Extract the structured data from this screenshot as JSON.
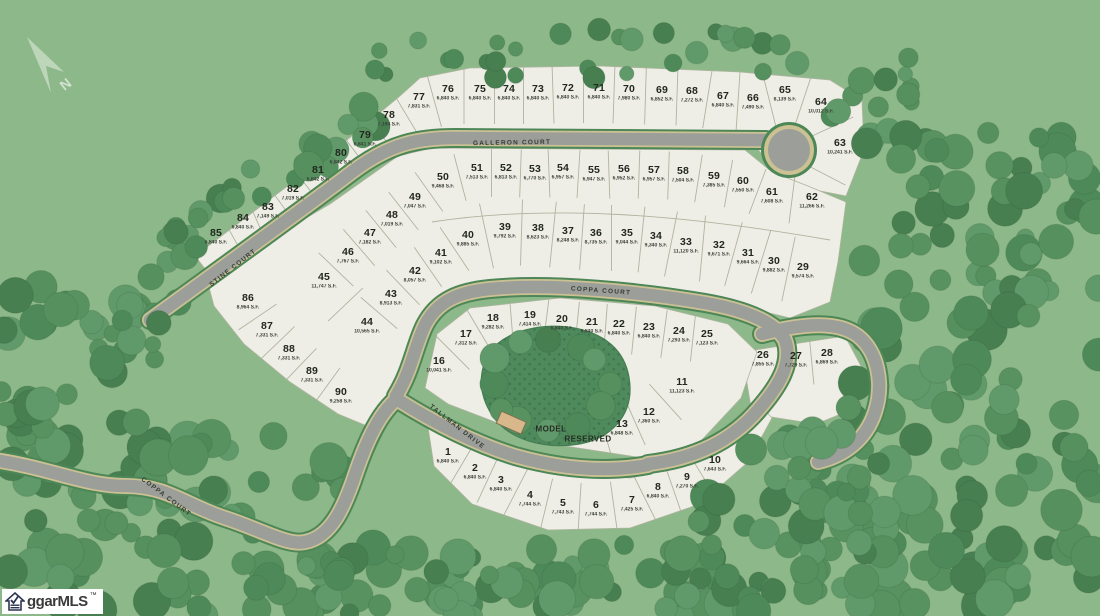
{
  "map": {
    "north_label": "N",
    "logo": {
      "text": "ggarMLS",
      "tm": "™"
    },
    "streets": [
      {
        "name": "GALLERON COURT",
        "x": 512,
        "y": 143,
        "rot": -1
      },
      {
        "name": "COPPA COURT",
        "x": 601,
        "y": 291,
        "rot": 4
      },
      {
        "name": "STINE COURT",
        "x": 233,
        "y": 268,
        "rot": -38
      },
      {
        "name": "TALLMAN DRIVE",
        "x": 457,
        "y": 427,
        "rot": 38
      },
      {
        "name": "COPPA COURT",
        "x": 166,
        "y": 497,
        "rot": 37
      }
    ],
    "special_lots": [
      {
        "label": "MODEL",
        "x": 551,
        "y": 429
      },
      {
        "label": "RESERVED",
        "x": 588,
        "y": 439
      }
    ],
    "lots": [
      {
        "n": "1",
        "sf": "6,840 S.F.",
        "x": 448,
        "y": 457
      },
      {
        "n": "2",
        "sf": "6,840 S.F.",
        "x": 475,
        "y": 473
      },
      {
        "n": "3",
        "sf": "6,840 S.F.",
        "x": 501,
        "y": 485
      },
      {
        "n": "4",
        "sf": "7,744 S.F.",
        "x": 530,
        "y": 500
      },
      {
        "n": "5",
        "sf": "7,743 S.F.",
        "x": 563,
        "y": 508
      },
      {
        "n": "6",
        "sf": "7,744 S.F.",
        "x": 596,
        "y": 510
      },
      {
        "n": "7",
        "sf": "7,425 S.F.",
        "x": 632,
        "y": 505
      },
      {
        "n": "8",
        "sf": "6,840 S.F.",
        "x": 658,
        "y": 492
      },
      {
        "n": "9",
        "sf": "7,270 S.F.",
        "x": 687,
        "y": 482
      },
      {
        "n": "10",
        "sf": "7,643 S.F.",
        "x": 715,
        "y": 465
      },
      {
        "n": "11",
        "sf": "11,123 S.F.",
        "x": 682,
        "y": 387
      },
      {
        "n": "12",
        "sf": "7,360 S.F.",
        "x": 649,
        "y": 417
      },
      {
        "n": "13",
        "sf": "6,848 S.F.",
        "x": 622,
        "y": 429
      },
      {
        "n": "16",
        "sf": "10,041 S.F.",
        "x": 439,
        "y": 366
      },
      {
        "n": "17",
        "sf": "7,312 S.F.",
        "x": 466,
        "y": 339
      },
      {
        "n": "18",
        "sf": "9,282 S.F.",
        "x": 493,
        "y": 323
      },
      {
        "n": "19",
        "sf": "7,414 S.F.",
        "x": 530,
        "y": 320
      },
      {
        "n": "20",
        "sf": "6,840 S.F.",
        "x": 562,
        "y": 324
      },
      {
        "n": "21",
        "sf": "6,840 S.F.",
        "x": 592,
        "y": 327
      },
      {
        "n": "22",
        "sf": "6,840 S.F.",
        "x": 619,
        "y": 329
      },
      {
        "n": "23",
        "sf": "6,840 S.F.",
        "x": 649,
        "y": 332
      },
      {
        "n": "24",
        "sf": "7,293 S.F.",
        "x": 679,
        "y": 336
      },
      {
        "n": "25",
        "sf": "7,123 S.F.",
        "x": 707,
        "y": 339
      },
      {
        "n": "26",
        "sf": "7,855 S.F.",
        "x": 763,
        "y": 360
      },
      {
        "n": "27",
        "sf": "7,729 S.F.",
        "x": 796,
        "y": 361
      },
      {
        "n": "28",
        "sf": "6,869 S.F.",
        "x": 827,
        "y": 358
      },
      {
        "n": "29",
        "sf": "9,574 S.F.",
        "x": 803,
        "y": 272
      },
      {
        "n": "30",
        "sf": "9,882 S.F.",
        "x": 774,
        "y": 266
      },
      {
        "n": "31",
        "sf": "9,664 S.F.",
        "x": 748,
        "y": 258
      },
      {
        "n": "32",
        "sf": "9,671 S.F.",
        "x": 719,
        "y": 250
      },
      {
        "n": "33",
        "sf": "11,120 S.F.",
        "x": 686,
        "y": 247
      },
      {
        "n": "34",
        "sf": "9,340 S.F.",
        "x": 656,
        "y": 241
      },
      {
        "n": "35",
        "sf": "9,044 S.F.",
        "x": 627,
        "y": 238
      },
      {
        "n": "36",
        "sf": "8,735 S.F.",
        "x": 596,
        "y": 238
      },
      {
        "n": "37",
        "sf": "8,248 S.F.",
        "x": 568,
        "y": 236
      },
      {
        "n": "38",
        "sf": "8,623 S.F.",
        "x": 538,
        "y": 233
      },
      {
        "n": "39",
        "sf": "9,792 S.F.",
        "x": 505,
        "y": 232
      },
      {
        "n": "40",
        "sf": "9,885 S.F.",
        "x": 468,
        "y": 240
      },
      {
        "n": "41",
        "sf": "9,102 S.F.",
        "x": 441,
        "y": 258
      },
      {
        "n": "42",
        "sf": "8,057 S.F.",
        "x": 415,
        "y": 276
      },
      {
        "n": "43",
        "sf": "8,913 S.F.",
        "x": 391,
        "y": 299
      },
      {
        "n": "44",
        "sf": "10,565 S.F.",
        "x": 367,
        "y": 327
      },
      {
        "n": "45",
        "sf": "11,747 S.F.",
        "x": 324,
        "y": 282
      },
      {
        "n": "46",
        "sf": "7,767 S.F.",
        "x": 348,
        "y": 257
      },
      {
        "n": "47",
        "sf": "7,182 S.F.",
        "x": 370,
        "y": 238
      },
      {
        "n": "48",
        "sf": "7,019 S.F.",
        "x": 392,
        "y": 220
      },
      {
        "n": "49",
        "sf": "7,047 S.F.",
        "x": 415,
        "y": 202
      },
      {
        "n": "50",
        "sf": "9,468 S.F.",
        "x": 443,
        "y": 182
      },
      {
        "n": "51",
        "sf": "7,513 S.F.",
        "x": 477,
        "y": 173
      },
      {
        "n": "52",
        "sf": "6,813 S.F.",
        "x": 506,
        "y": 173
      },
      {
        "n": "53",
        "sf": "6,770 S.F.",
        "x": 535,
        "y": 174
      },
      {
        "n": "54",
        "sf": "6,957 S.F.",
        "x": 563,
        "y": 173
      },
      {
        "n": "55",
        "sf": "6,947 S.F.",
        "x": 594,
        "y": 175
      },
      {
        "n": "56",
        "sf": "6,952 S.F.",
        "x": 624,
        "y": 174
      },
      {
        "n": "57",
        "sf": "6,957 S.F.",
        "x": 654,
        "y": 175
      },
      {
        "n": "58",
        "sf": "7,504 S.F.",
        "x": 683,
        "y": 176
      },
      {
        "n": "59",
        "sf": "7,385 S.F.",
        "x": 714,
        "y": 181
      },
      {
        "n": "60",
        "sf": "7,550 S.F.",
        "x": 743,
        "y": 186
      },
      {
        "n": "61",
        "sf": "7,608 S.F.",
        "x": 772,
        "y": 197
      },
      {
        "n": "62",
        "sf": "11,266 S.F.",
        "x": 812,
        "y": 202
      },
      {
        "n": "63",
        "sf": "10,241 S.F.",
        "x": 840,
        "y": 148
      },
      {
        "n": "64",
        "sf": "10,012 S.F.",
        "x": 821,
        "y": 107
      },
      {
        "n": "65",
        "sf": "8,139 S.F.",
        "x": 785,
        "y": 95
      },
      {
        "n": "66",
        "sf": "7,490 S.F.",
        "x": 753,
        "y": 103
      },
      {
        "n": "67",
        "sf": "6,840 S.F.",
        "x": 723,
        "y": 101
      },
      {
        "n": "68",
        "sf": "7,272 S.F.",
        "x": 692,
        "y": 96
      },
      {
        "n": "69",
        "sf": "6,852 S.F.",
        "x": 662,
        "y": 95
      },
      {
        "n": "70",
        "sf": "7,980 S.F.",
        "x": 629,
        "y": 94
      },
      {
        "n": "71",
        "sf": "6,840 S.F.",
        "x": 599,
        "y": 93
      },
      {
        "n": "72",
        "sf": "6,840 S.F.",
        "x": 568,
        "y": 93
      },
      {
        "n": "73",
        "sf": "6,840 S.F.",
        "x": 538,
        "y": 94
      },
      {
        "n": "74",
        "sf": "6,840 S.F.",
        "x": 509,
        "y": 94
      },
      {
        "n": "75",
        "sf": "6,840 S.F.",
        "x": 480,
        "y": 94
      },
      {
        "n": "76",
        "sf": "6,840 S.F.",
        "x": 448,
        "y": 94
      },
      {
        "n": "77",
        "sf": "7,831 S.F.",
        "x": 419,
        "y": 102
      },
      {
        "n": "78",
        "sf": "7,194 S.F.",
        "x": 389,
        "y": 120
      },
      {
        "n": "79",
        "sf": "6,841 S.F.",
        "x": 365,
        "y": 140
      },
      {
        "n": "80",
        "sf": "6,842 S.F.",
        "x": 341,
        "y": 158
      },
      {
        "n": "81",
        "sf": "6,842 S.F.",
        "x": 318,
        "y": 175
      },
      {
        "n": "82",
        "sf": "7,019 S.F.",
        "x": 293,
        "y": 194
      },
      {
        "n": "83",
        "sf": "7,149 S.F.",
        "x": 268,
        "y": 212
      },
      {
        "n": "84",
        "sf": "6,840 S.F.",
        "x": 243,
        "y": 223
      },
      {
        "n": "85",
        "sf": "6,840 S.F.",
        "x": 216,
        "y": 238
      },
      {
        "n": "86",
        "sf": "8,964 S.F.",
        "x": 248,
        "y": 303
      },
      {
        "n": "87",
        "sf": "7,331 S.F.",
        "x": 267,
        "y": 331
      },
      {
        "n": "88",
        "sf": "7,331 S.F.",
        "x": 289,
        "y": 354
      },
      {
        "n": "89",
        "sf": "7,331 S.F.",
        "x": 312,
        "y": 376
      },
      {
        "n": "90",
        "sf": "9,258 S.F.",
        "x": 341,
        "y": 397
      }
    ]
  },
  "colors": {
    "background": "#8db889",
    "parcel_fill": "#efeee6",
    "parcel_line": "#aeb49f",
    "road": "#9b9e99",
    "curb": "#cbc193",
    "road_casing": "#4d8758",
    "tree_greens": [
      "#4e8a59",
      "#589260",
      "#60996a",
      "#477f51",
      "#55905e"
    ],
    "reserved_area": "#4e8a5b",
    "building": "#d8b88a"
  }
}
